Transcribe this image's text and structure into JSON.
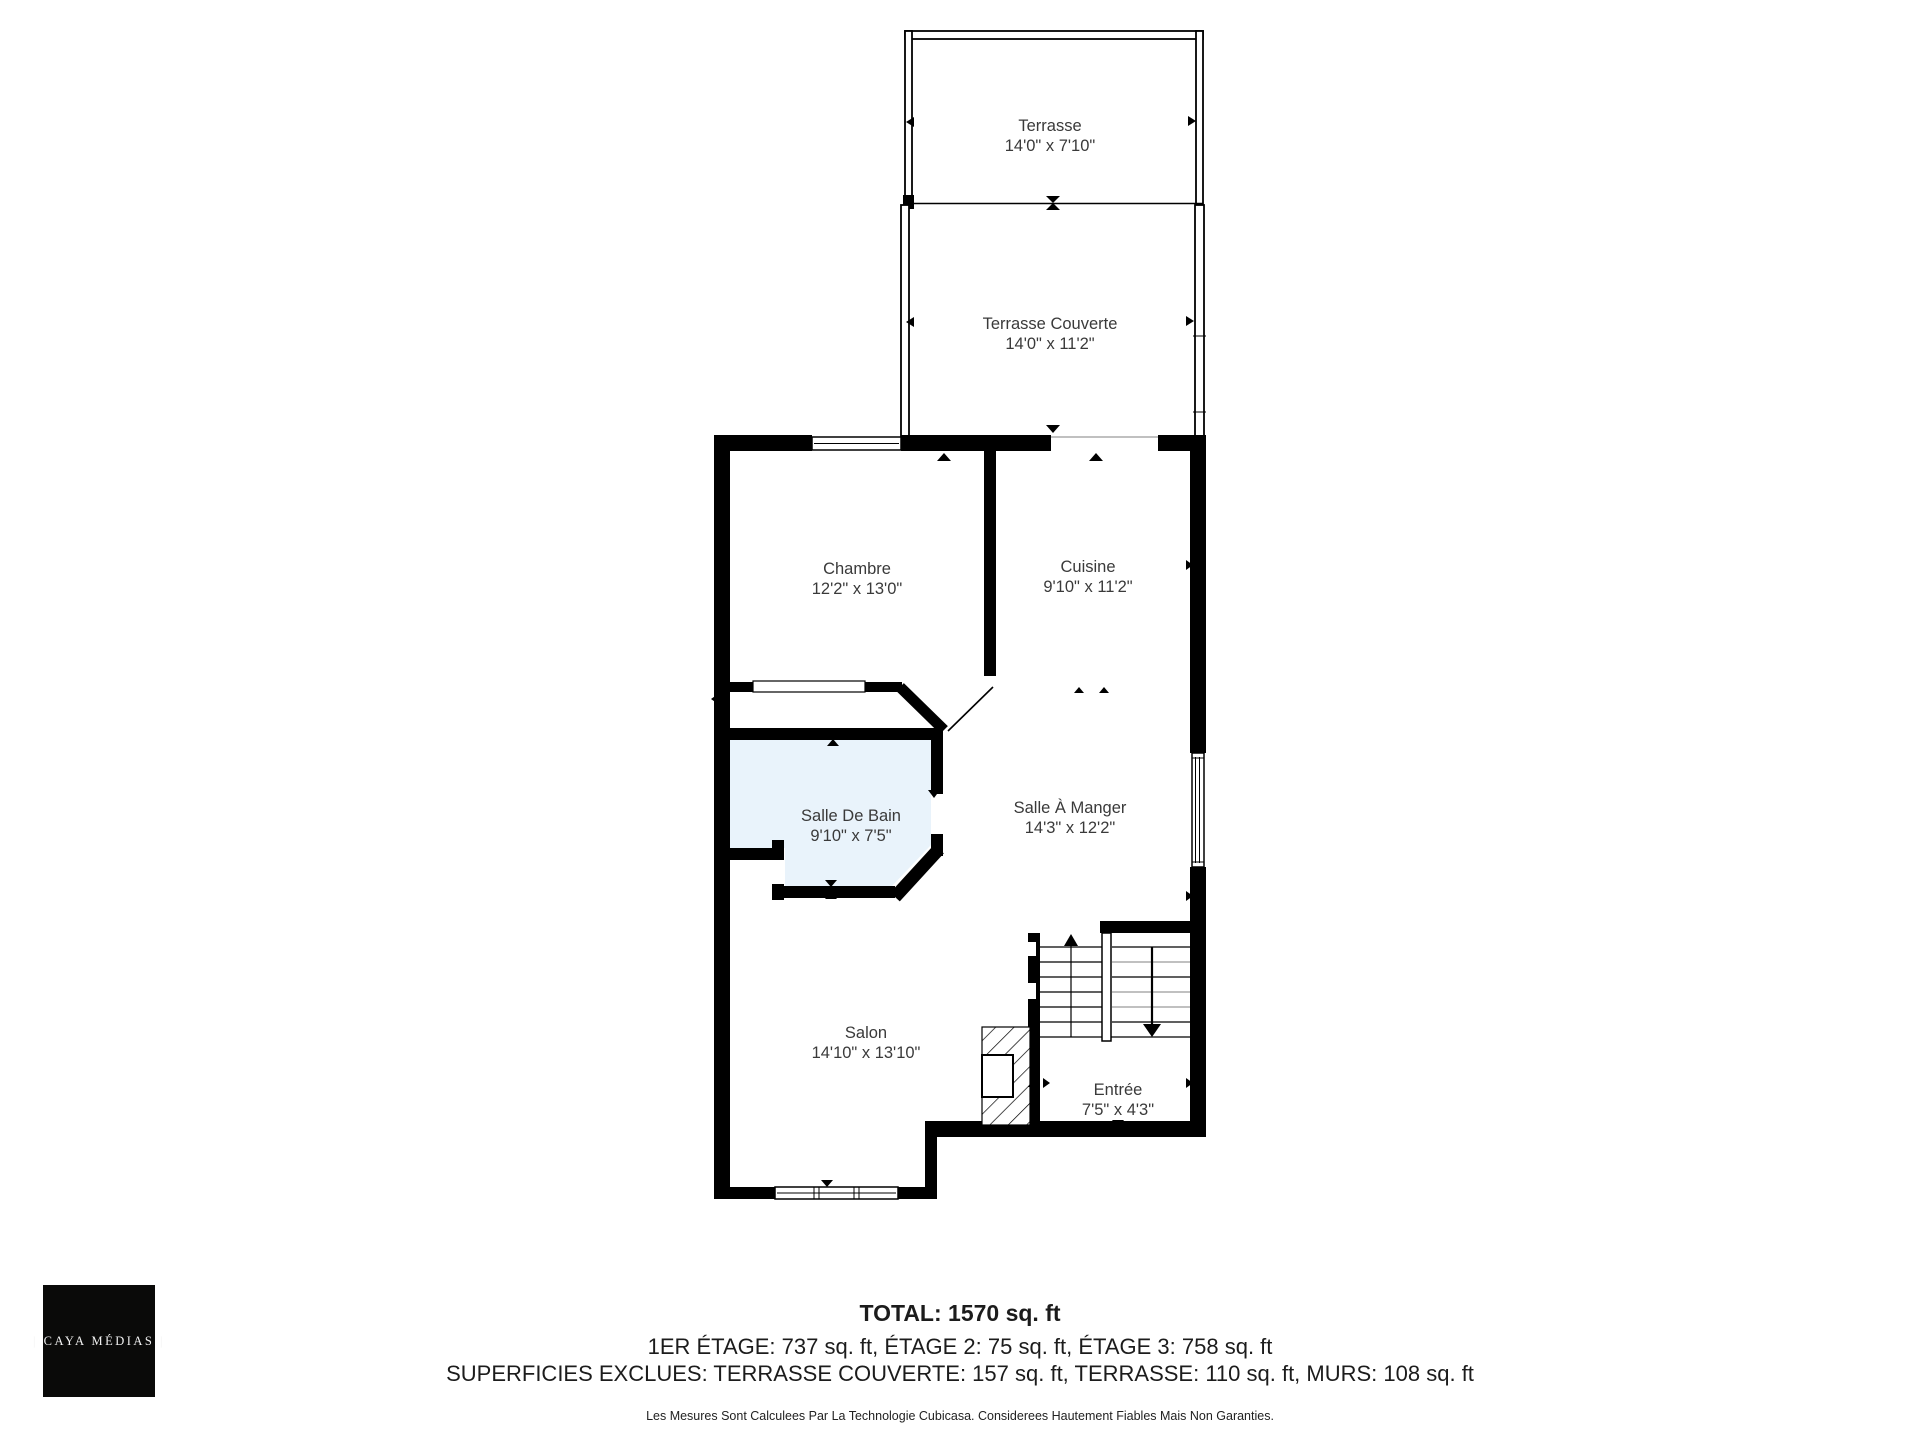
{
  "rooms": [
    {
      "id": "terrasse",
      "name": "Terrasse",
      "dims": "14'0\" x 7'10\""
    },
    {
      "id": "terrasse-couverte",
      "name": "Terrasse Couverte",
      "dims": "14'0\" x 11'2\""
    },
    {
      "id": "chambre",
      "name": "Chambre",
      "dims": "12'2\" x 13'0\""
    },
    {
      "id": "cuisine",
      "name": "Cuisine",
      "dims": "9'10\" x 11'2\""
    },
    {
      "id": "salle-de-bain",
      "name": "Salle De Bain",
      "dims": "9'10\" x 7'5\""
    },
    {
      "id": "salle-a-manger",
      "name": "Salle À Manger",
      "dims": "14'3\" x 12'2\""
    },
    {
      "id": "salon",
      "name": "Salon",
      "dims": "14'10\" x 13'10\""
    },
    {
      "id": "entree",
      "name": "Entrée",
      "dims": "7'5\" x 4'3\""
    }
  ],
  "summary": {
    "total": "TOTAL: 1570 sq. ft",
    "floors": "1ER ÉTAGE: 737 sq. ft, ÉTAGE 2: 75 sq. ft, ÉTAGE 3: 758 sq. ft",
    "excluded": "SUPERFICIES EXCLUES: TERRASSE COUVERTE: 157 sq. ft, TERRASSE: 110 sq. ft, MURS: 108 sq. ft",
    "disclaimer": "Les Mesures Sont Calculees Par La Technologie Cubicasa. Considerees Hautement Fiables Mais Non Garanties."
  },
  "logo": {
    "text": "| CAYA MÉDIAS |"
  },
  "colors": {
    "wall": "#000000",
    "bathroom_fill": "#e9f3fb",
    "background": "#ffffff",
    "logo_background": "#0a0a09",
    "label_text": "#3a3a3a"
  }
}
